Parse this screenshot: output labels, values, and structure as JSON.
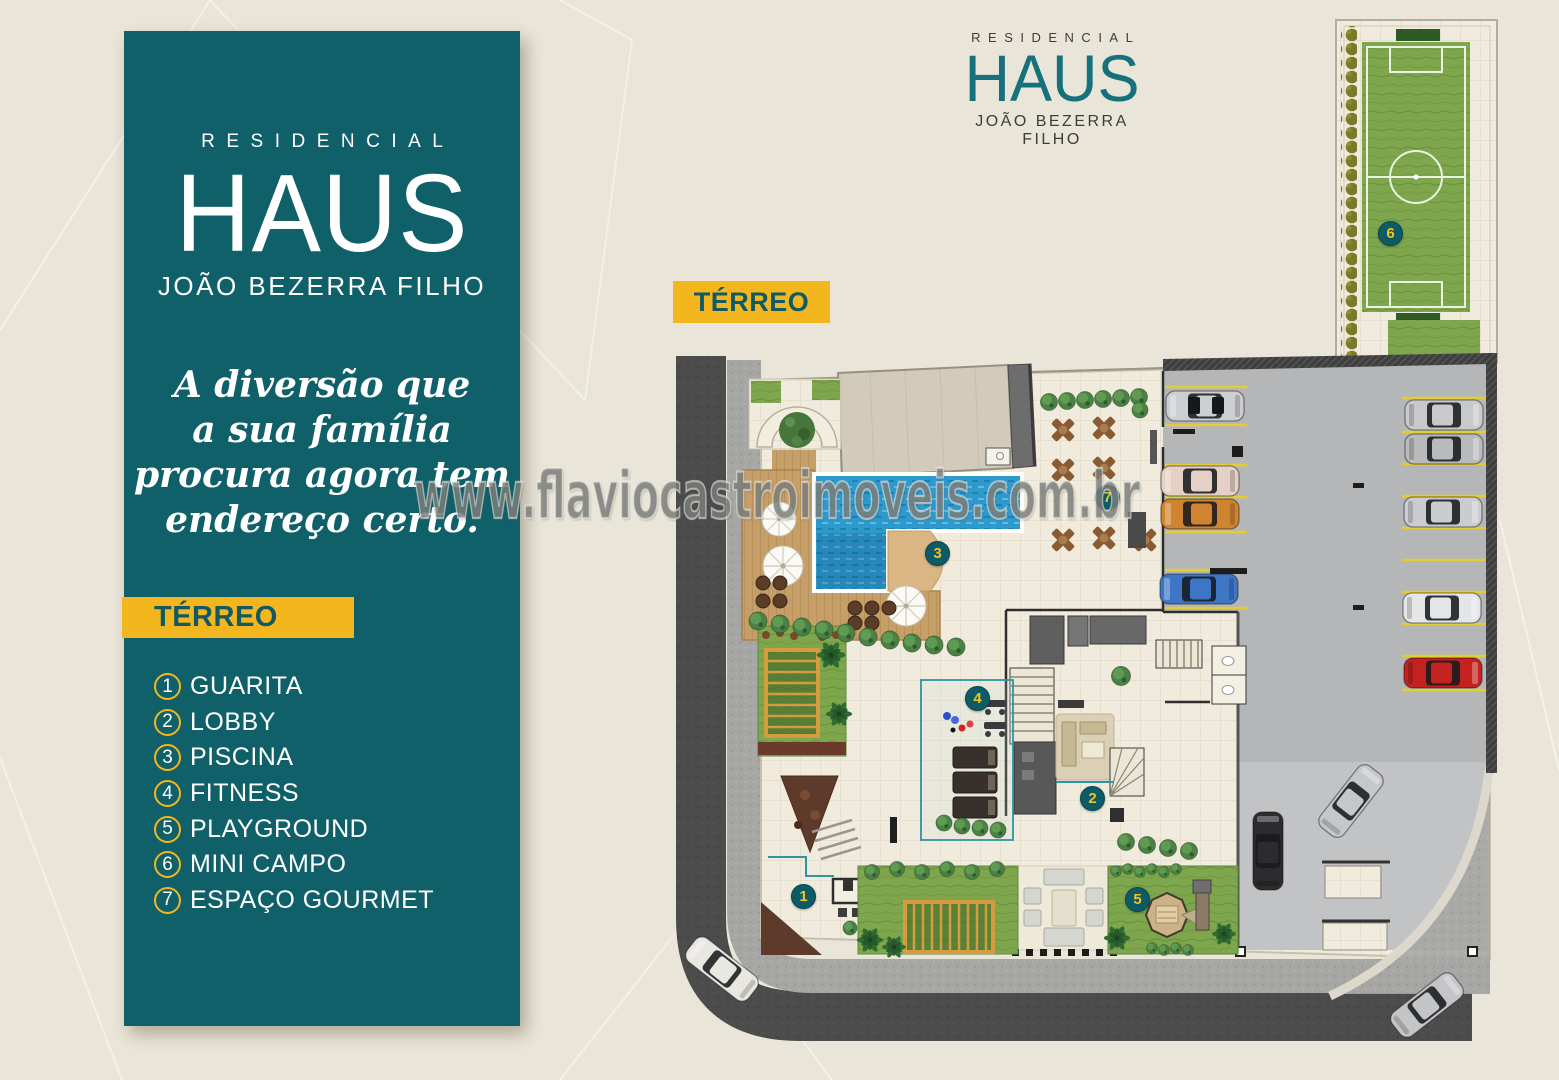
{
  "brand": {
    "kicker": "RESIDENCIAL",
    "name": "HAUS",
    "subname": "JOÃO BEZERRA FILHO"
  },
  "sidebar": {
    "tagline_lines": [
      "A diversão que",
      "a sua família",
      "procura agora tem",
      "endereço certo."
    ],
    "floor_badge": "TÉRREO",
    "amenities": [
      {
        "num": "1",
        "label": "GUARITA"
      },
      {
        "num": "2",
        "label": "LOBBY"
      },
      {
        "num": "3",
        "label": "PISCINA"
      },
      {
        "num": "4",
        "label": "FITNESS"
      },
      {
        "num": "5",
        "label": "PLAYGROUND"
      },
      {
        "num": "6",
        "label": "MINI CAMPO"
      },
      {
        "num": "7",
        "label": "ESPAÇO GOURMET"
      }
    ]
  },
  "plan": {
    "floor_badge": "TÉRREO",
    "markers": [
      {
        "num": "1",
        "label": "guarita"
      },
      {
        "num": "2",
        "label": "lobby"
      },
      {
        "num": "3",
        "label": "piscina"
      },
      {
        "num": "4",
        "label": "fitness"
      },
      {
        "num": "5",
        "label": "playground"
      },
      {
        "num": "6",
        "label": "mini-campo"
      },
      {
        "num": "7",
        "label": "espaco-gourmet"
      }
    ]
  },
  "watermark": "www.flaviocastroimoveis.com.br",
  "colors": {
    "teal_panel": "#10606a",
    "accent_yellow": "#f3b61e",
    "marker_teal": "#0c5b66",
    "marker_number_yellow": "#f4c31c",
    "background_beige": "#e9e5d8",
    "pool_blue": "#2d9ace",
    "grass_green": "#7ea64c"
  }
}
